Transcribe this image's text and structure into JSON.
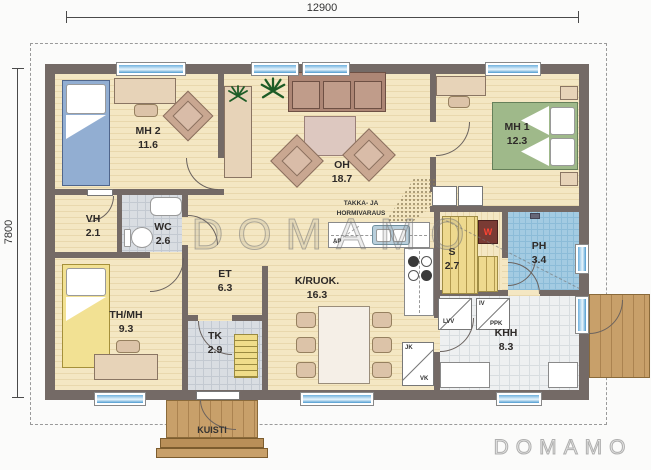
{
  "dimensions": {
    "top": "12900",
    "left": "7800"
  },
  "rooms": [
    {
      "id": "mh2",
      "name": "MH 2",
      "area": "11.6"
    },
    {
      "id": "oh",
      "name": "OH",
      "area": "18.7"
    },
    {
      "id": "mh1",
      "name": "MH 1",
      "area": "12.3"
    },
    {
      "id": "vh",
      "name": "VH",
      "area": "2.1"
    },
    {
      "id": "wc",
      "name": "WC",
      "area": "2.6"
    },
    {
      "id": "et",
      "name": "ET",
      "area": "6.3"
    },
    {
      "id": "thmh",
      "name": "TH/MH",
      "area": "9.3"
    },
    {
      "id": "tk",
      "name": "TK",
      "area": "2.9"
    },
    {
      "id": "kruok",
      "name": "K/RUOK.",
      "area": "16.3"
    },
    {
      "id": "s",
      "name": "S",
      "area": "2.7"
    },
    {
      "id": "ph",
      "name": "PH",
      "area": "3.4"
    },
    {
      "id": "khh",
      "name": "KHH",
      "area": "8.3"
    }
  ],
  "annotations": {
    "fireplace_line1": "TAKKA- JA",
    "fireplace_line2": "HORMIVARAUS",
    "porch": "KUISTI"
  },
  "appliances": {
    "ap": "AP",
    "lvv": "LVV",
    "iv": "IV",
    "ppk": "PPK",
    "jk": "JK",
    "vk": "VK"
  },
  "watermarks": {
    "center": "DOMAMO",
    "corner": "DOMAMO"
  },
  "colors": {
    "wall": "#746a66",
    "floor_wood": "#f4e7c3",
    "window_blue": "#5aa7d8",
    "tile_shower": "#a3cbe2",
    "bed_blue": "#92aed2",
    "bed_green": "#9fb98a",
    "bed_yellow": "#f2e193",
    "deck_wood": "#c8a06a"
  }
}
